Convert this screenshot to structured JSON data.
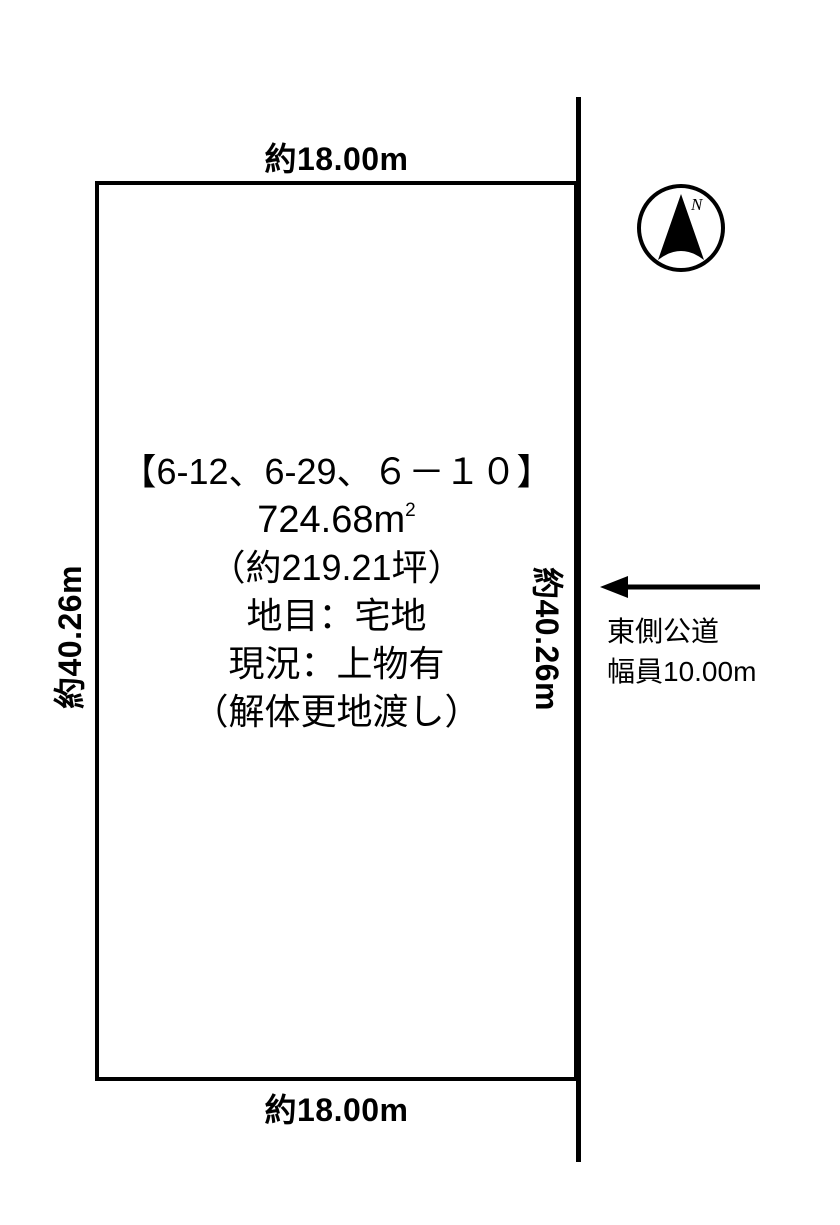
{
  "colors": {
    "ink": "#000000",
    "background": "#ffffff"
  },
  "plot": {
    "dimensions": {
      "top": "約18.00m",
      "bottom": "約18.00m",
      "left": "約40.26m",
      "right": "約40.26m"
    },
    "info": {
      "parcel_numbers": "【6-12、6-29、６－１０】",
      "area_sqm_value": "724.68",
      "area_sqm_unit": "m",
      "area_sqm_exponent": "2",
      "area_tsubo": "（約219.21坪）",
      "land_category": "地目：宅地",
      "current_status": "現況：上物有",
      "handover_condition": "（解体更地渡し）"
    }
  },
  "road": {
    "name": "東側公道",
    "width_label": "幅員10.00m"
  },
  "compass": {
    "label": "N"
  }
}
